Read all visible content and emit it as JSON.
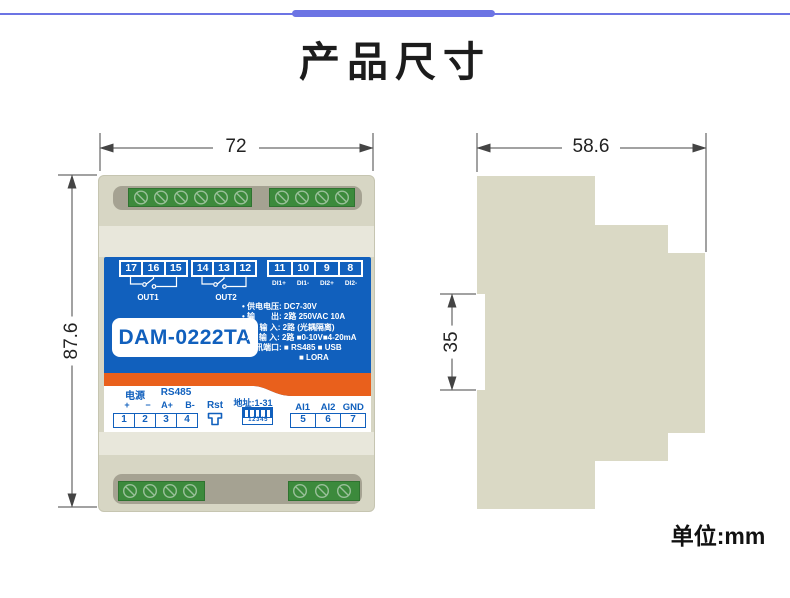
{
  "header": {
    "title": "产品尺寸",
    "accent_color": "#6c74e4"
  },
  "footer": {
    "unit_label": "单位:mm"
  },
  "front_view": {
    "dims": {
      "width": "72",
      "height": "87.6"
    },
    "label": {
      "model": "DAM-0222TA",
      "relay_terminals_1": [
        "17",
        "16",
        "15"
      ],
      "relay_terminals_2": [
        "14",
        "13",
        "12"
      ],
      "di_terminals": [
        "11",
        "10",
        "9",
        "8"
      ],
      "di_labels": [
        "DI1+",
        "DI1-",
        "DI2+",
        "DI2-"
      ],
      "out1_label": "OUT1",
      "out2_label": "OUT2",
      "specs": [
        "• 供电电压: DC7-30V",
        "• 输　　出: 2路 250VAC 10A",
        "• D I 输 入: 2路 (光耦隔离)",
        "• A I 输 入: 2路 ■0-10V■4-20mA",
        "• 通讯端口: ■ RS485 ■ USB",
        "■ LORA"
      ],
      "power_label": "电源",
      "rs485_label": "RS485",
      "polarity": [
        "+",
        "−",
        "A+",
        "B-"
      ],
      "power_terminals": [
        "1",
        "2",
        "3",
        "4"
      ],
      "rst_label": "Rst",
      "address_label": "地址:1-31",
      "dip_numbers": "1 2 3 4 5",
      "analog_labels": [
        "AI1",
        "AI2",
        "GND"
      ],
      "analog_terminals": [
        "5",
        "6",
        "7"
      ]
    },
    "colors": {
      "label_blue": "#1160bd",
      "orange": "#e9601c",
      "terminal_green": "#3c8a3c",
      "body": "#d7d6c4"
    }
  },
  "side_view": {
    "dims": {
      "depth": "58.6",
      "rail": "35"
    }
  }
}
